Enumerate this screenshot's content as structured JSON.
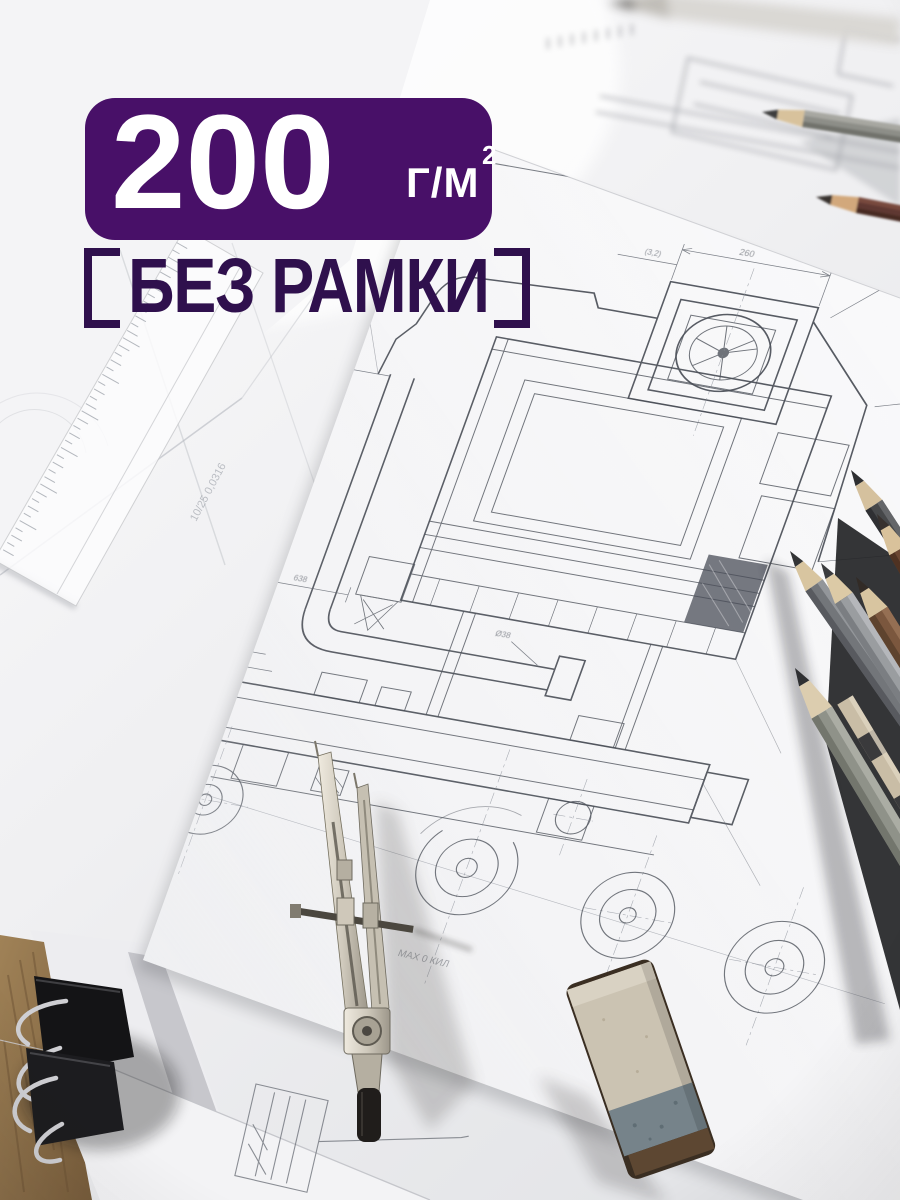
{
  "page": {
    "kind": "marketplace-product-photo",
    "width": 900,
    "height": 1200
  },
  "overlay": {
    "badge": {
      "value": "200",
      "unit": "Г/М",
      "unit_exponent": "2",
      "bg_color": "#481068",
      "text_color": "#ffffff"
    },
    "no_frame": {
      "bracket_left": "[",
      "text": "БЕЗ РАМКИ",
      "bracket_right": "]",
      "color": "#2f104d"
    }
  },
  "blueprint": {
    "line_color": "#3f444d",
    "annotations": {
      "dim_top": "260",
      "dim_roughness": "(3,2)",
      "dim_small": "1,6",
      "dim_side": "40",
      "dim_bottom": "638",
      "dim_leader": "Ø38",
      "balloon": "1",
      "stamp_left": "ЛЮМ ОЛУ 0,0Л0",
      "stamp_right": "2ЫЛА 1ЛОВ",
      "note_pencil": "МАХ 0 КИЛ",
      "note_diagonal": "10/25 0,0316"
    }
  }
}
